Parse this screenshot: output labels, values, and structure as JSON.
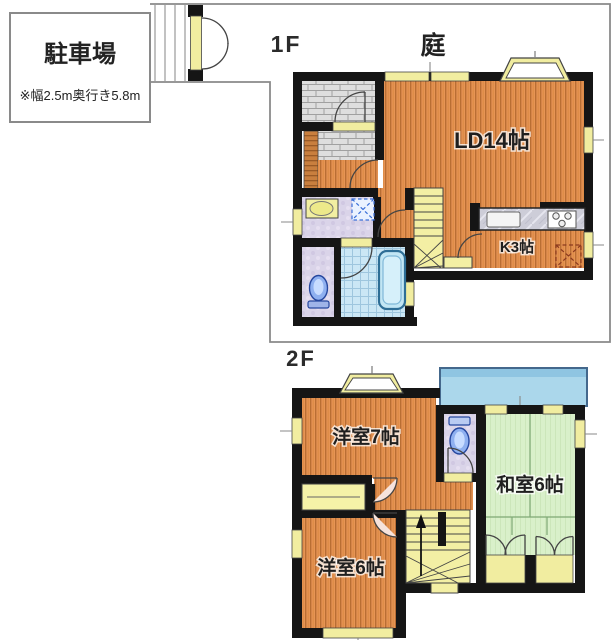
{
  "parking": {
    "label": "駐車場",
    "note": "※幅2.5m奥行き5.8m"
  },
  "floor1": {
    "label": "1F",
    "garden_label": "庭",
    "rooms": {
      "ld": {
        "label": "LD14帖"
      },
      "kitchen": {
        "label": "K3帖"
      }
    }
  },
  "floor2": {
    "label": "2F",
    "rooms": {
      "western7": {
        "label": "洋室7帖"
      },
      "japanese6": {
        "label": "和室6帖"
      },
      "western6": {
        "label": "洋室6帖"
      }
    }
  },
  "colors": {
    "wall": "#151515",
    "wood_floor": "#E69455",
    "tatami": "#D9F0CA",
    "balcony": "#ABD7EB",
    "bath_tile": "#CBE7F5",
    "window_yellow": "#F1EDA0",
    "entrance_gray": "#DEDEDE",
    "washroom_lavender": "#DAD4E9",
    "boundary_line": "#8A8A8A"
  }
}
